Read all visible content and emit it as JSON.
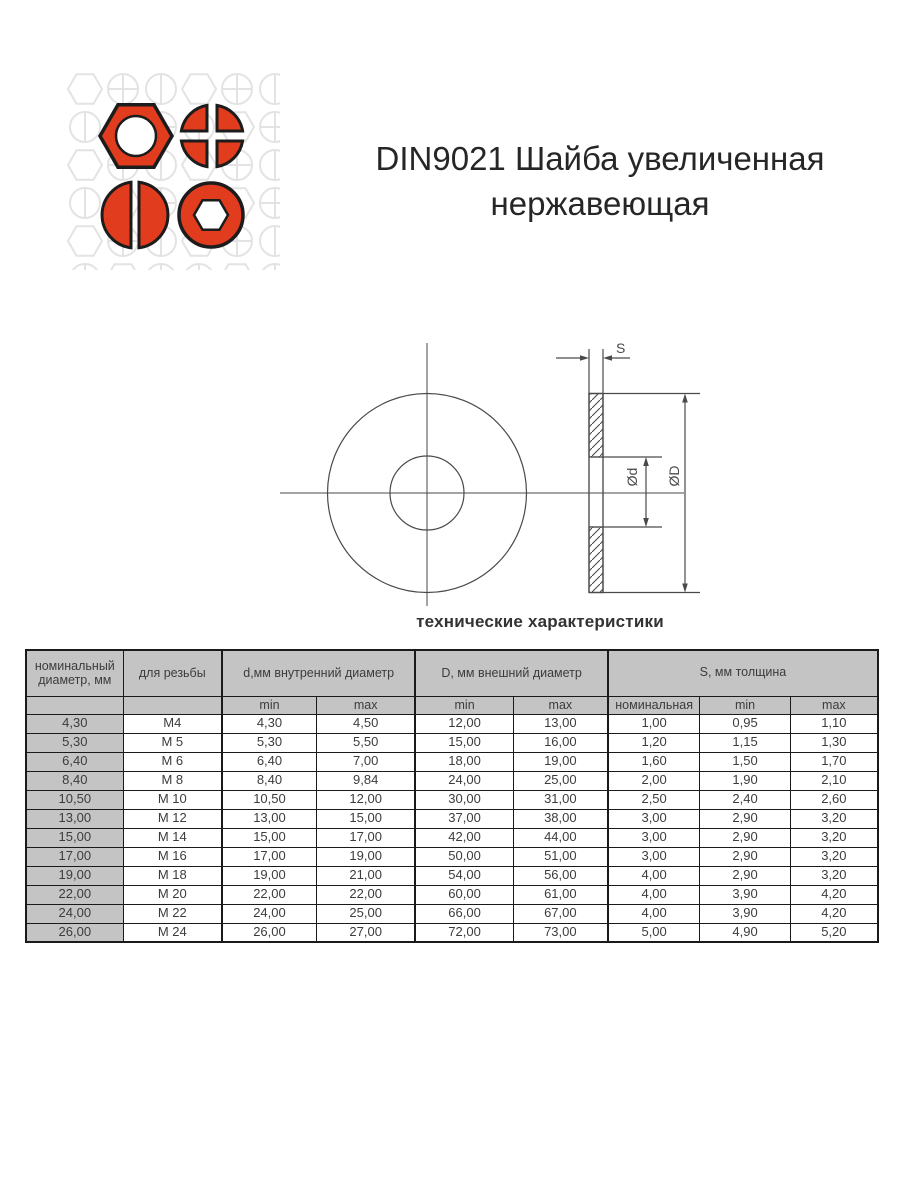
{
  "colors": {
    "brand_red": "#e23c1e",
    "outline_dark": "#1c1c1c",
    "pattern_gray": "#e3e3e3",
    "title_text": "#262626",
    "drawing_stroke": "#4a4a4a",
    "table_border": "#1a1a1a",
    "table_header_bg": "#c4c4c4",
    "table_text": "#3c3c3c",
    "caption_text": "#333333",
    "page_bg": "#ffffff"
  },
  "logo": {
    "icons": [
      "hex-nut",
      "phillips-head",
      "slotted-head",
      "socket-head"
    ]
  },
  "title": {
    "line1": "DIN9021 Шайба увеличенная",
    "line2": "нержавеющая"
  },
  "drawing": {
    "thickness_label": "S",
    "inner_diameter_label": "Ød",
    "outer_diameter_label": "ØD",
    "caption": "технические характеристики"
  },
  "table": {
    "header": {
      "col_nominal": "номинальный диаметр, мм",
      "col_thread": "для резьбы",
      "group_d": "d,мм внутренний диаметр",
      "group_D": "D, мм внешний диаметр",
      "group_S": "S, мм толщина",
      "sub_min": "min",
      "sub_max": "max",
      "sub_nominal": "номинальная"
    },
    "rows": [
      [
        "4,30",
        "M4",
        "4,30",
        "4,50",
        "12,00",
        "13,00",
        "1,00",
        "0,95",
        "1,10"
      ],
      [
        "5,30",
        "M 5",
        "5,30",
        "5,50",
        "15,00",
        "16,00",
        "1,20",
        "1,15",
        "1,30"
      ],
      [
        "6,40",
        "M 6",
        "6,40",
        "7,00",
        "18,00",
        "19,00",
        "1,60",
        "1,50",
        "1,70"
      ],
      [
        "8,40",
        "M 8",
        "8,40",
        "9,84",
        "24,00",
        "25,00",
        "2,00",
        "1,90",
        "2,10"
      ],
      [
        "10,50",
        "M 10",
        "10,50",
        "12,00",
        "30,00",
        "31,00",
        "2,50",
        "2,40",
        "2,60"
      ],
      [
        "13,00",
        "M 12",
        "13,00",
        "15,00",
        "37,00",
        "38,00",
        "3,00",
        "2,90",
        "3,20"
      ],
      [
        "15,00",
        "M 14",
        "15,00",
        "17,00",
        "42,00",
        "44,00",
        "3,00",
        "2,90",
        "3,20"
      ],
      [
        "17,00",
        "M 16",
        "17,00",
        "19,00",
        "50,00",
        "51,00",
        "3,00",
        "2,90",
        "3,20"
      ],
      [
        "19,00",
        "M 18",
        "19,00",
        "21,00",
        "54,00",
        "56,00",
        "4,00",
        "2,90",
        "3,20"
      ],
      [
        "22,00",
        "M 20",
        "22,00",
        "22,00",
        "60,00",
        "61,00",
        "4,00",
        "3,90",
        "4,20"
      ],
      [
        "24,00",
        "M 22",
        "24,00",
        "25,00",
        "66,00",
        "67,00",
        "4,00",
        "3,90",
        "4,20"
      ],
      [
        "26,00",
        "M 24",
        "26,00",
        "27,00",
        "72,00",
        "73,00",
        "5,00",
        "4,90",
        "5,20"
      ]
    ]
  }
}
